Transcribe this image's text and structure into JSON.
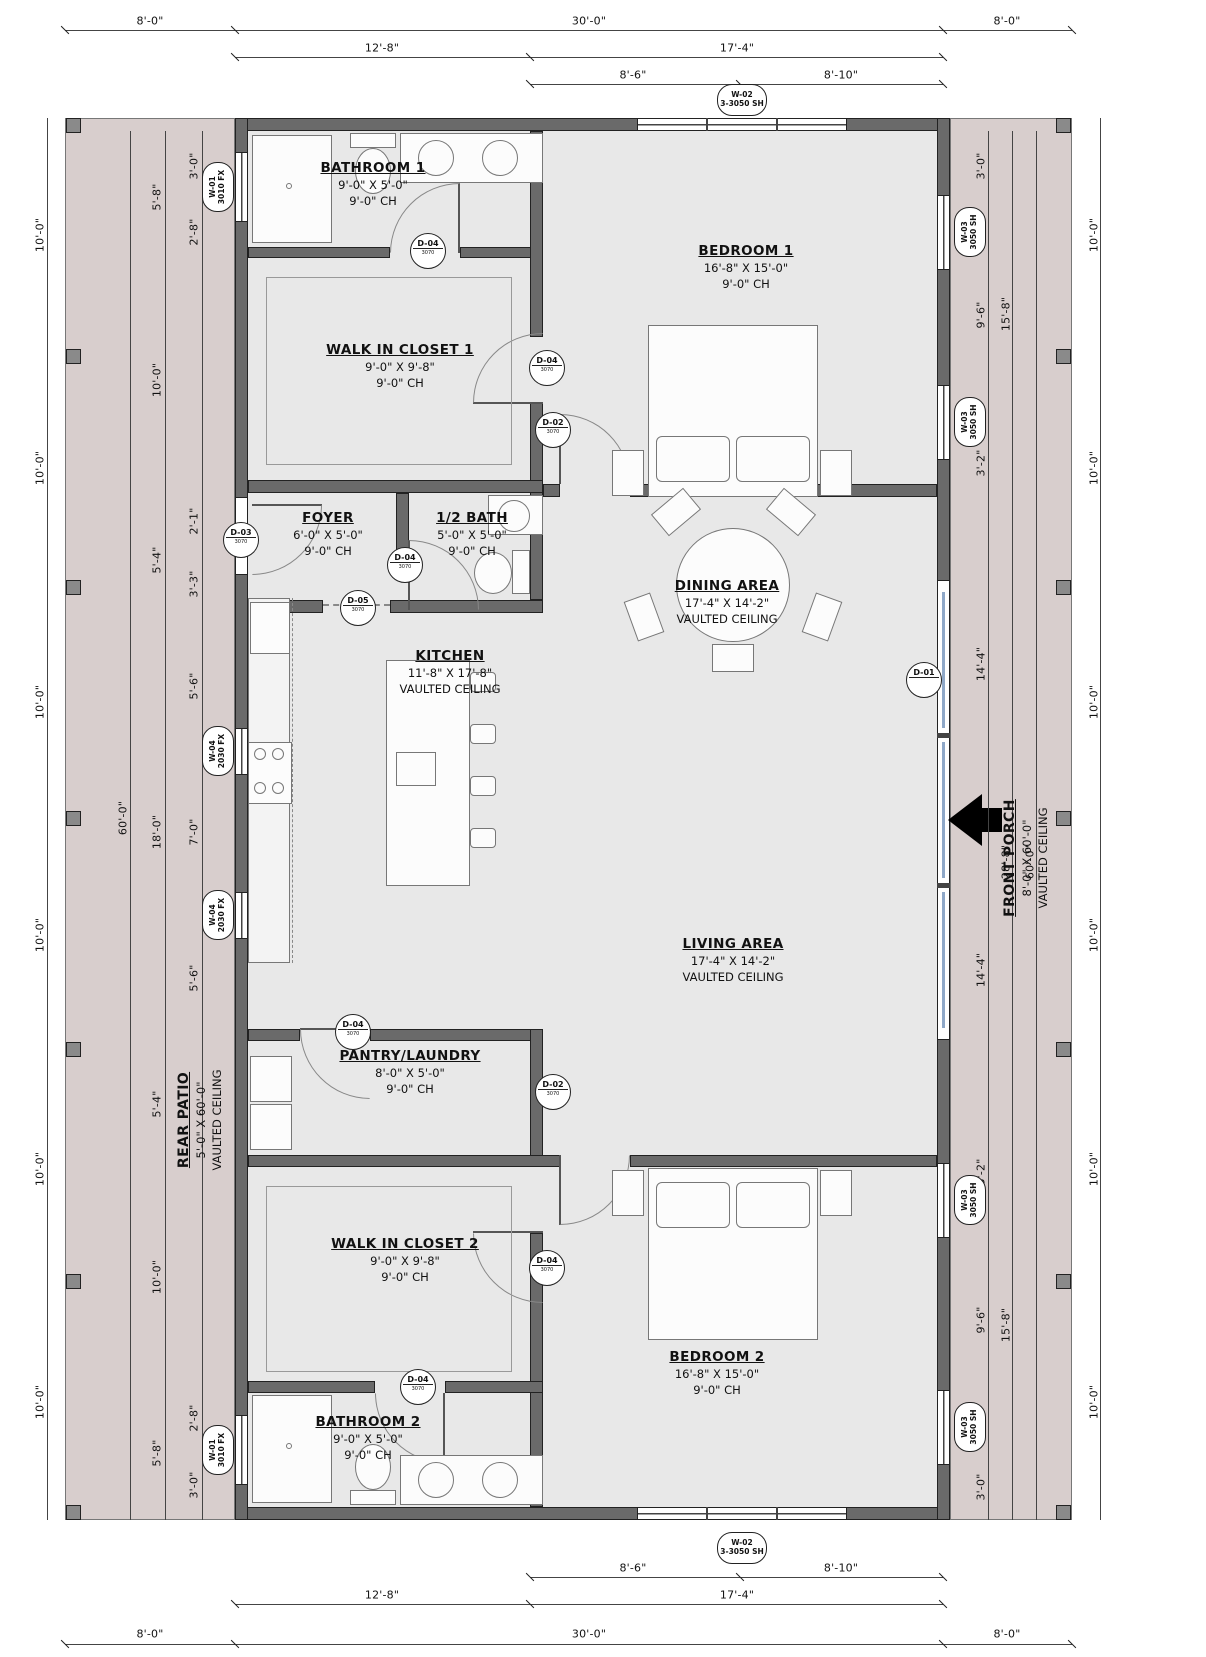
{
  "meta": {
    "drawing_type": "residential floor plan"
  },
  "colors": {
    "patio_fill": "#d8cecd",
    "wall_fill": "#6a6a6a",
    "room_fill": "#e8e8e8",
    "line": "#444444"
  },
  "rooms": {
    "bathroom1": {
      "name": "BATHROOM 1",
      "dims": "9'-0\" X 5'-0\"",
      "ceiling": "9'-0\" CH"
    },
    "bedroom1": {
      "name": "BEDROOM 1",
      "dims": "16'-8\" X 15'-0\"",
      "ceiling": "9'-0\" CH"
    },
    "wic1": {
      "name": "WALK IN CLOSET 1",
      "dims": "9'-0\" X 9'-8\"",
      "ceiling": "9'-0\" CH"
    },
    "foyer": {
      "name": "FOYER",
      "dims": "6'-0\" X 5'-0\"",
      "ceiling": "9'-0\" CH"
    },
    "halfbath": {
      "name": "1/2 BATH",
      "dims": "5'-0\" X 5'-0\"",
      "ceiling": "9'-0\" CH"
    },
    "dining": {
      "name": "DINING AREA",
      "dims": "17'-4\" X 14'-2\"",
      "ceiling": "VAULTED CEILING"
    },
    "kitchen": {
      "name": "KITCHEN",
      "dims": "11'-8\" X 17'-8\"",
      "ceiling": "VAULTED CEILING"
    },
    "living": {
      "name": "LIVING AREA",
      "dims": "17'-4\" X 14'-2\"",
      "ceiling": "VAULTED CEILING"
    },
    "pantry": {
      "name": "PANTRY/LAUNDRY",
      "dims": "8'-0\" X 5'-0\"",
      "ceiling": "9'-0\" CH"
    },
    "wic2": {
      "name": "WALK IN CLOSET 2",
      "dims": "9'-0\" X 9'-8\"",
      "ceiling": "9'-0\" CH"
    },
    "bedroom2": {
      "name": "BEDROOM 2",
      "dims": "16'-8\" X 15'-0\"",
      "ceiling": "9'-0\" CH"
    },
    "bathroom2": {
      "name": "BATHROOM 2",
      "dims": "9'-0\" X 5'-0\"",
      "ceiling": "9'-0\" CH"
    },
    "rear_patio": {
      "name": "REAR PATIO",
      "dims": "5'-0\" X 60'-0\"",
      "ceiling": "VAULTED CEILING"
    },
    "front_porch": {
      "name": "FRONT PORCH",
      "dims": "8'-0\" X 60'-0\"",
      "ceiling": "VAULTED CEILING"
    }
  },
  "dims": {
    "top1": [
      "8'-0\"",
      "30'-0\"",
      "8'-0\""
    ],
    "top2": [
      "12'-8\"",
      "17'-4\""
    ],
    "top3": [
      "8'-6\"",
      "8'-10\""
    ],
    "bot3": [
      "8'-6\"",
      "8'-10\""
    ],
    "bot2": [
      "12'-8\"",
      "17'-4\""
    ],
    "bot1": [
      "8'-0\"",
      "30'-0\"",
      "8'-0\""
    ],
    "left_outer": [
      "10'-0\"",
      "10'-0\"",
      "10'-0\"",
      "10'-0\"",
      "10'-0\"",
      "10'-0\""
    ],
    "left_total": "60'-0\"",
    "left_mid": [
      "5'-8\"",
      "10'-0\"",
      "5'-4\"",
      "18'-0\"",
      "5'-4\"",
      "10'-0\"",
      "5'-8\""
    ],
    "left_inner": [
      "3'-0\"",
      "2'-8\"",
      "2'-1\"",
      "3'-3\"",
      "5'-6\"",
      "7'-0\"",
      "5'-6\"",
      "2'-8\"",
      "3'-0\""
    ],
    "right_outer": [
      "10'-0\"",
      "10'-0\"",
      "10'-0\"",
      "10'-0\"",
      "10'-0\"",
      "10'-0\""
    ],
    "right_total": "60'-0\"",
    "right_mid": [
      "15'-8\"",
      "28'-8\"",
      "15'-8\""
    ],
    "right_inner": [
      "3'-0\"",
      "9'-6\"",
      "3'-2\"",
      "14'-4\"",
      "14'-4\"",
      "3'-2\"",
      "9'-6\"",
      "3'-0\""
    ]
  },
  "window_tags": {
    "w01": {
      "code": "W-01",
      "size": "3010 FX"
    },
    "w02": {
      "code": "W-02",
      "size": "3-3050 SH"
    },
    "w03": {
      "code": "W-03",
      "size": "3050 SH"
    },
    "w04": {
      "code": "W-04",
      "size": "2030 FX"
    }
  },
  "door_tags": {
    "d01": {
      "code": "D-01",
      "size": ""
    },
    "d02": {
      "code": "D-02",
      "size": "3070"
    },
    "d03": {
      "code": "D-03",
      "size": "3070"
    },
    "d04": {
      "code": "D-04",
      "size": "3070"
    },
    "d05": {
      "code": "D-05",
      "size": "3070"
    }
  }
}
